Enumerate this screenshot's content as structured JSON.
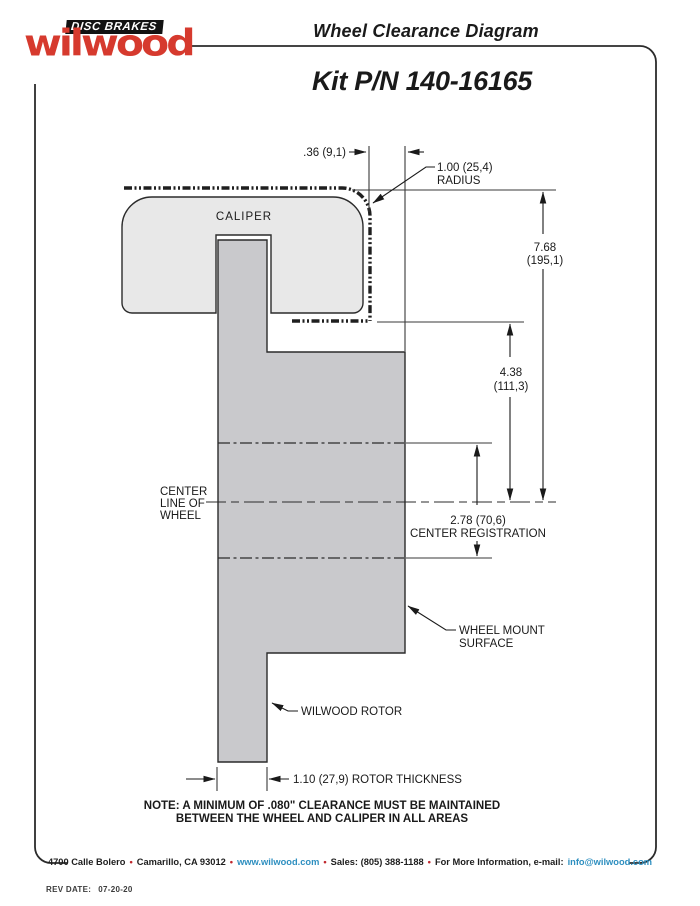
{
  "header": {
    "brand_script": "wilwood",
    "brand_banner": "DISC BRAKES",
    "title": "Wheel Clearance Diagram",
    "kit_number": "Kit P/N 140-16165"
  },
  "diagram": {
    "caliper_label": "CALIPER",
    "dim_wheel_gap": ".36 (9,1)",
    "radius_value": "1.00 (25,4)",
    "radius_word": "RADIUS",
    "dim_height_value": "7.68",
    "dim_height_metric": "(195,1)",
    "dim_mid_value": "4.38",
    "dim_mid_metric": "(111,3)",
    "centerline_word1": "CENTER",
    "centerline_word2": "LINE OF",
    "centerline_word3": "WHEEL",
    "registration_value": "2.78 (70,6)",
    "registration_label": "CENTER REGISTRATION",
    "wheel_mount_word1": "WHEEL MOUNT",
    "wheel_mount_word2": "SURFACE",
    "rotor_label": "WILWOOD ROTOR",
    "rotor_thickness_label": "1.10 (27,9) ROTOR THICKNESS",
    "note_line1": "NOTE: A MINIMUM OF .080\" CLEARANCE MUST BE MAINTAINED",
    "note_line2": "BETWEEN THE WHEEL AND CALIPER IN ALL AREAS",
    "colors": {
      "caliper_fill": "#e8e8e8",
      "rotor_fill": "#c9c9cc",
      "outline": "#2b2b2b"
    }
  },
  "footer": {
    "address": "4700 Calle Bolero",
    "city": "Camarillo, CA 93012",
    "website": "www.wilwood.com",
    "sales": "Sales: (805) 388-1188",
    "more_info": "For More Information, e-mail:",
    "email": "info@wilwood.com",
    "separator": "•",
    "link_color": "#2e8fc0",
    "bullet_color": "#c0272d",
    "rev_label": "REV DATE:",
    "rev_value": "07-20-20"
  }
}
